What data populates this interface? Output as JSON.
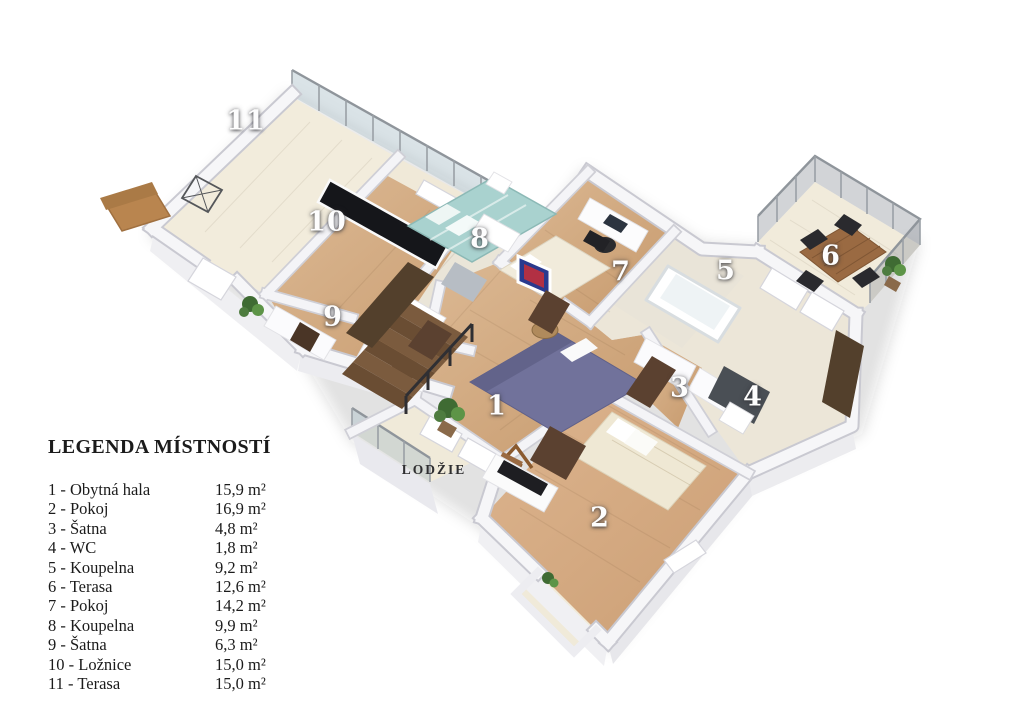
{
  "legend": {
    "title": "LEGENDA MÍSTNOSTÍ",
    "items": [
      {
        "label": "1 - Obytná hala",
        "area": "15,9 m²"
      },
      {
        "label": "2 - Pokoj",
        "area": "16,9 m²"
      },
      {
        "label": "3 - Šatna",
        "area": "4,8 m²"
      },
      {
        "label": "4 - WC",
        "area": "1,8 m²"
      },
      {
        "label": "5 - Koupelna",
        "area": "9,2 m²"
      },
      {
        "label": "6 - Terasa",
        "area": "12,6 m²"
      },
      {
        "label": "7 - Pokoj",
        "area": "14,2 m²"
      },
      {
        "label": "8 - Koupelna",
        "area": "9,9 m²"
      },
      {
        "label": "9 - Šatna",
        "area": "6,3 m²"
      },
      {
        "label": "10 - Ložnice",
        "area": "15,0 m²"
      },
      {
        "label": "11 - Terasa",
        "area": "15,0 m²"
      }
    ]
  },
  "plan": {
    "room_labels": [
      {
        "id": "terasa-11",
        "text": "11",
        "x": 246,
        "y": 121
      },
      {
        "id": "loznice-10",
        "text": "10",
        "x": 327,
        "y": 222
      },
      {
        "id": "koupelna-8",
        "text": "8",
        "x": 480,
        "y": 239
      },
      {
        "id": "satna-9",
        "text": "9",
        "x": 333,
        "y": 317
      },
      {
        "id": "pokoj-7",
        "text": "7",
        "x": 621,
        "y": 272
      },
      {
        "id": "koupelna-5",
        "text": "5",
        "x": 726,
        "y": 271
      },
      {
        "id": "terasa-6",
        "text": "6",
        "x": 831,
        "y": 256
      },
      {
        "id": "obytna-hala-1",
        "text": "1",
        "x": 497,
        "y": 406
      },
      {
        "id": "satna-3",
        "text": "3",
        "x": 680,
        "y": 388
      },
      {
        "id": "wc-4",
        "text": "4",
        "x": 753,
        "y": 397
      },
      {
        "id": "pokoj-2",
        "text": "2",
        "x": 600,
        "y": 518
      }
    ],
    "area_labels": [
      {
        "id": "lodzie",
        "text": "LODŽIE",
        "x": 434,
        "y": 470
      }
    ]
  },
  "colors": {
    "floor_wood": "#d2ab82",
    "floor_pale": "#f2ecdc",
    "floor_bath": "#eae5d8",
    "wall_white": "#f6f6f8",
    "bed_teal": "#a9d2cf",
    "sofa_purple": "#71729b",
    "door_brown": "#5b4130",
    "panel_dark_brown": "#53402c",
    "wc_panel_gray": "#4a4f55",
    "table_wood": "#9a6a42",
    "legend_text": "#1b1b1b",
    "room_number_text": "#fdfdfd"
  }
}
